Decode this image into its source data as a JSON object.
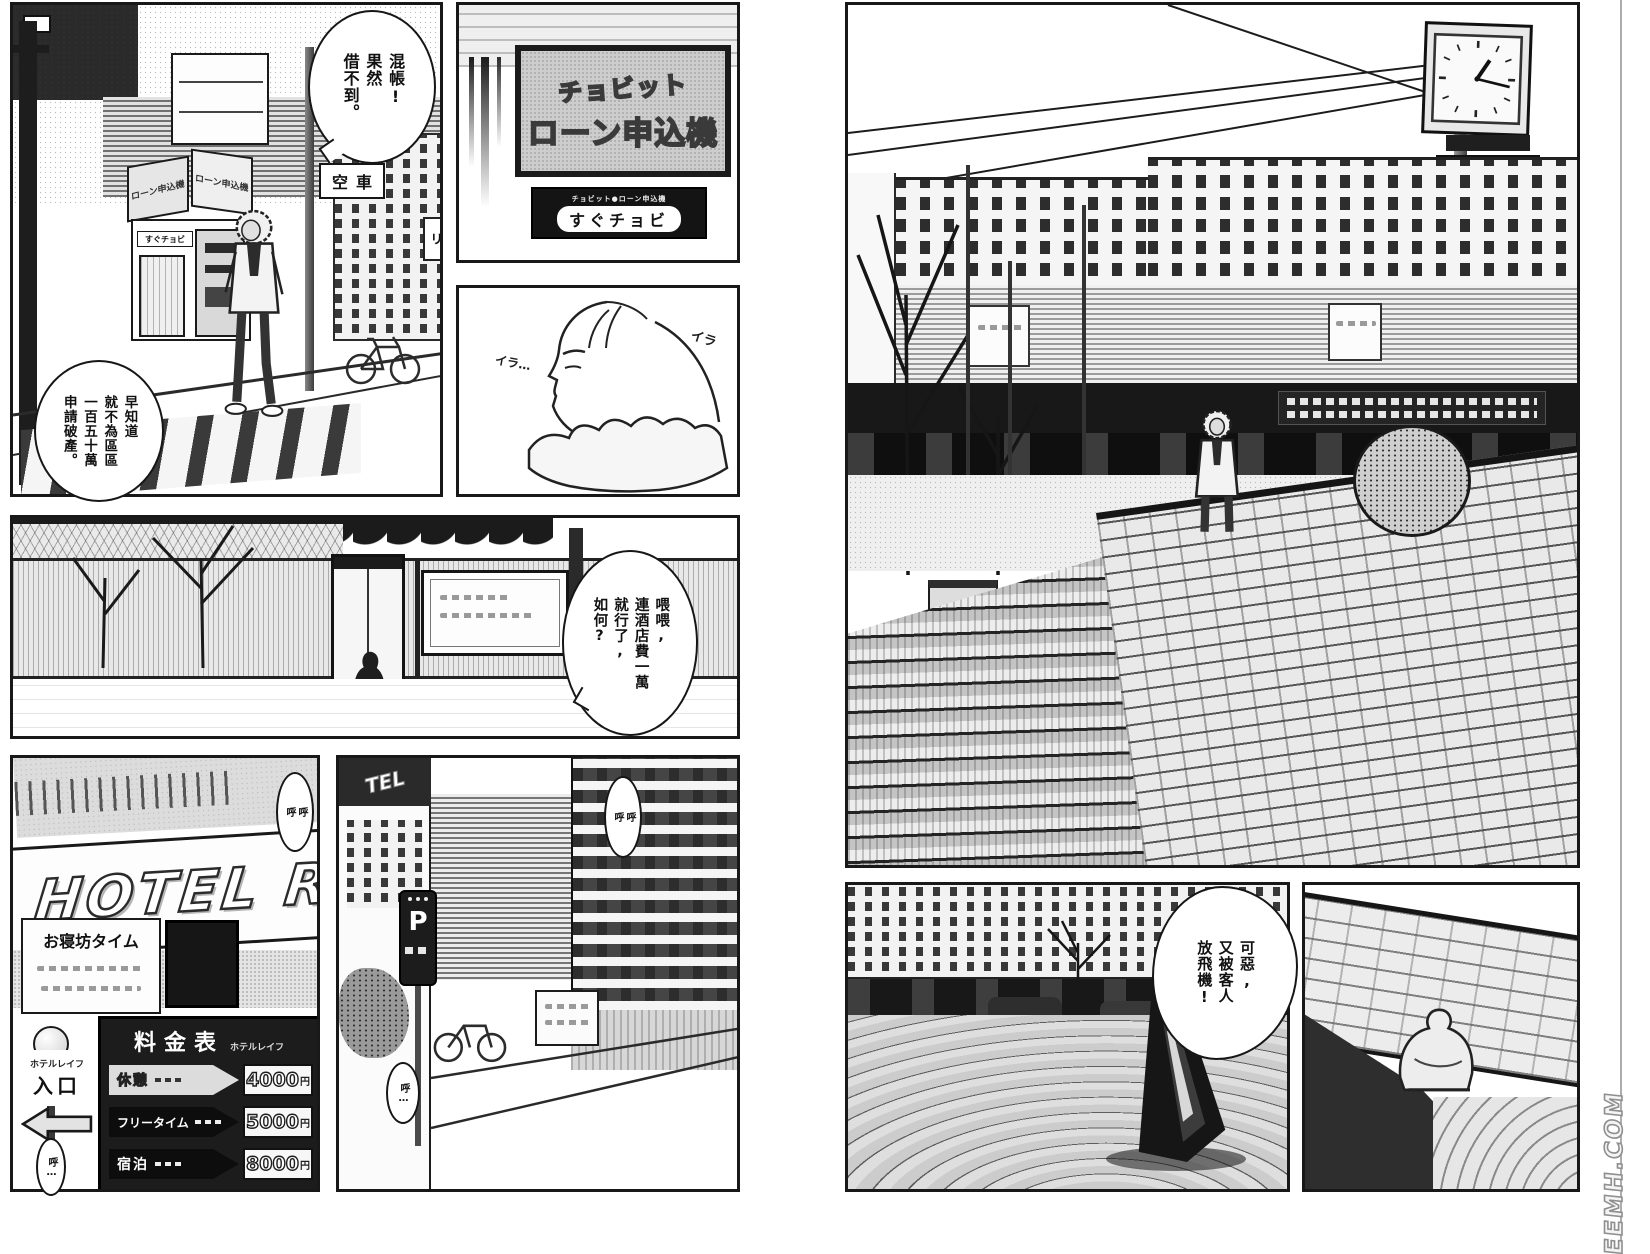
{
  "colors": {
    "paper": "#ffffff",
    "ink": "#171717",
    "tone_gray": "#c9c9c9",
    "sign_black": "#141414"
  },
  "bubbles": {
    "damn": "混帳!\n果然\n借不到。",
    "bankruptcy": "早知道\n就不為區區\n一百五十萬\n申請破產。",
    "hotel_fee": "喂喂,\n連酒店費一萬\n就行了,\n如何?",
    "stood_up": "可惡,\n又被客人\n放飛機!"
  },
  "sfx": {
    "irritated_1": "イラ",
    "irritated_2": "イラ…",
    "snore_1": "呼\n呼",
    "snore_2": "呼…",
    "snore_3": "呼\n呼",
    "snore_4": "呼…"
  },
  "signs": {
    "loan_board_title": "チョビット",
    "loan_board_main": "ローン申込機",
    "loan_strip_small": "チョビット●ローン申込機",
    "loan_strip_brand": "すぐチョビ",
    "taxi": "空車",
    "ri": "リ",
    "booth_face_left": "ローン申込機",
    "booth_face_right": "ローン申込機",
    "booth_small": "すぐチョビ",
    "hotel_neon": "HOTEL R",
    "alley_hotel": "TEL",
    "nap_time": "お寝坊タイム",
    "entrance_name": "ホテルレイフ",
    "entrance": "入口",
    "parking": "P"
  },
  "price_board": {
    "title": "料金表",
    "subtitle": "ホテルレイフ",
    "rows": [
      {
        "label": "休憩",
        "price": "4000",
        "unit": "円",
        "variant": "light"
      },
      {
        "label": "フリータイム",
        "price": "5000",
        "unit": "円",
        "variant": "dark"
      },
      {
        "label": "宿泊",
        "price": "8000",
        "unit": "円",
        "variant": "dark"
      }
    ]
  },
  "watermark": "SEEMH.COM"
}
